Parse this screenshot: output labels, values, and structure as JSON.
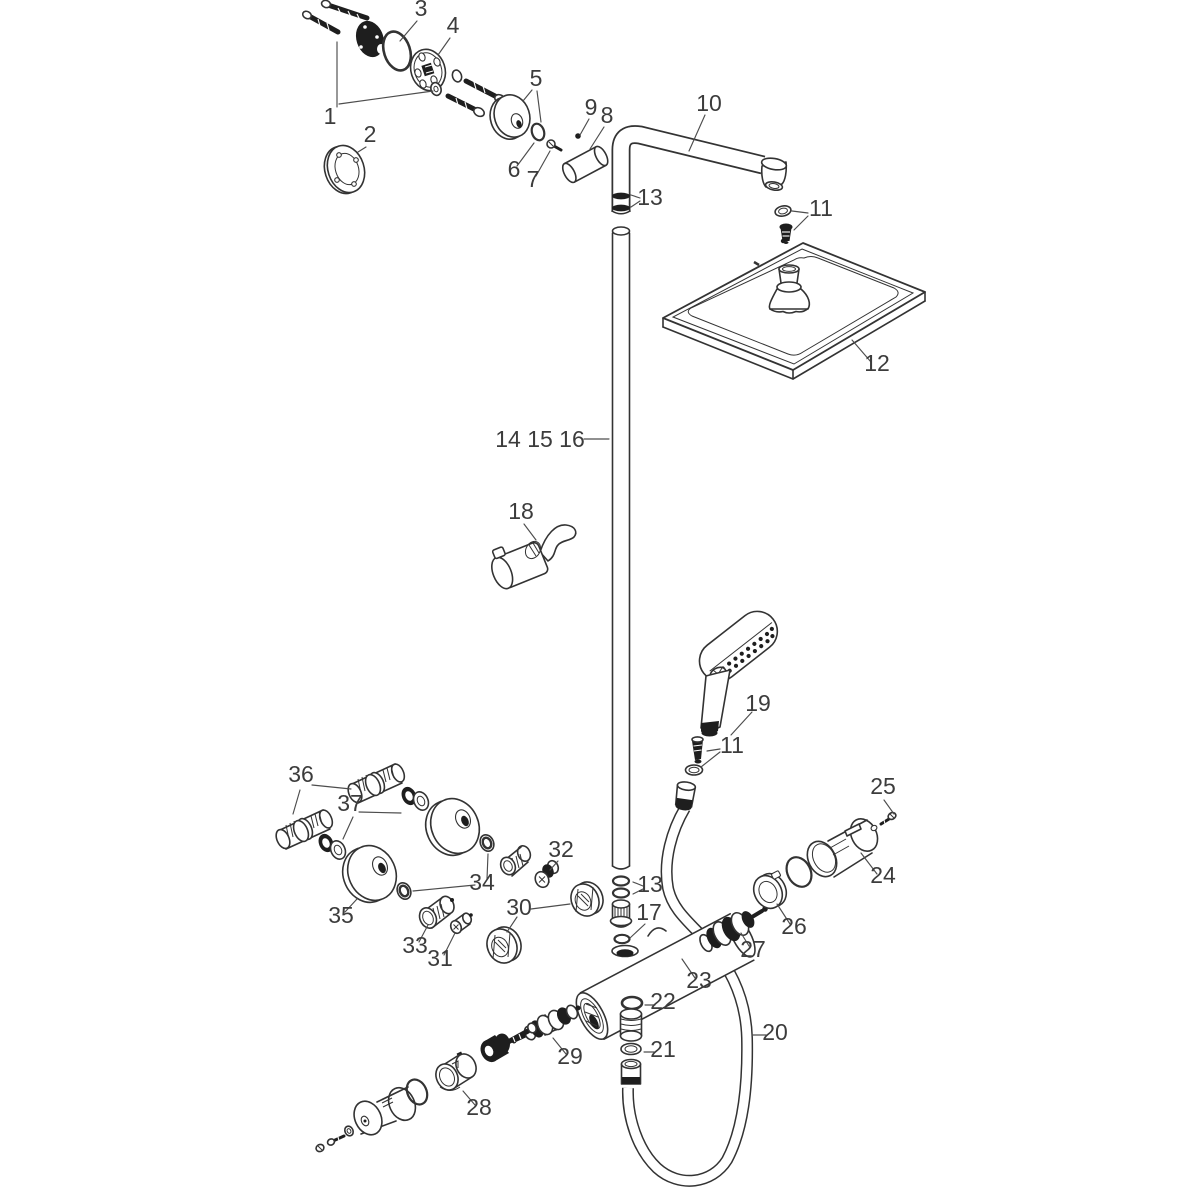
{
  "colors": {
    "background": "#ffffff",
    "line": "#333333",
    "dark_fill": "#1e1e1e",
    "label_text": "#3c3c3c",
    "leader_line": "#4d4d4d"
  },
  "labels": [
    {
      "id": "part-1",
      "text": "1"
    },
    {
      "id": "part-2",
      "text": "2"
    },
    {
      "id": "part-3",
      "text": "3"
    },
    {
      "id": "part-4",
      "text": "4"
    },
    {
      "id": "part-5",
      "text": "5"
    },
    {
      "id": "part-6",
      "text": "6"
    },
    {
      "id": "part-7",
      "text": "7"
    },
    {
      "id": "part-8",
      "text": "8"
    },
    {
      "id": "part-9",
      "text": "9"
    },
    {
      "id": "part-10",
      "text": "10"
    },
    {
      "id": "part-11-top",
      "text": "11"
    },
    {
      "id": "part-12",
      "text": "12"
    },
    {
      "id": "part-13-top",
      "text": "13"
    },
    {
      "id": "part-14-15-16",
      "text": "14 15 16"
    },
    {
      "id": "part-18",
      "text": "18"
    },
    {
      "id": "part-19",
      "text": "19"
    },
    {
      "id": "part-11-mid",
      "text": "11"
    },
    {
      "id": "part-36",
      "text": "36"
    },
    {
      "id": "part-37",
      "text": "37"
    },
    {
      "id": "part-35",
      "text": "35"
    },
    {
      "id": "part-34",
      "text": "34"
    },
    {
      "id": "part-33",
      "text": "33"
    },
    {
      "id": "part-31",
      "text": "31"
    },
    {
      "id": "part-30",
      "text": "30"
    },
    {
      "id": "part-32",
      "text": "32"
    },
    {
      "id": "part-13-low",
      "text": "13"
    },
    {
      "id": "part-17",
      "text": "17"
    },
    {
      "id": "part-23",
      "text": "23"
    },
    {
      "id": "part-22",
      "text": "22"
    },
    {
      "id": "part-20",
      "text": "20"
    },
    {
      "id": "part-21",
      "text": "21"
    },
    {
      "id": "part-29",
      "text": "29"
    },
    {
      "id": "part-24",
      "text": "24"
    },
    {
      "id": "part-25",
      "text": "25"
    },
    {
      "id": "part-26",
      "text": "26"
    },
    {
      "id": "part-27",
      "text": "27"
    },
    {
      "id": "part-28",
      "text": "28"
    }
  ]
}
